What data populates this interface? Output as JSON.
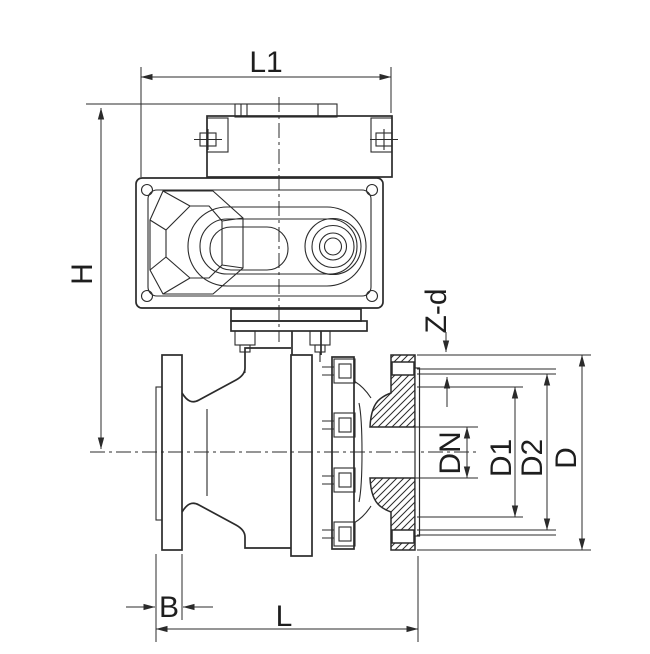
{
  "style": {
    "background": "#ffffff",
    "line_color": "#2b2b2b"
  },
  "labels": {
    "l1": "L1",
    "h": "H",
    "zd": "Z-d",
    "dn": "DN",
    "d1": "D1",
    "d2": "D2",
    "d": "D",
    "b": "B",
    "l": "L"
  }
}
